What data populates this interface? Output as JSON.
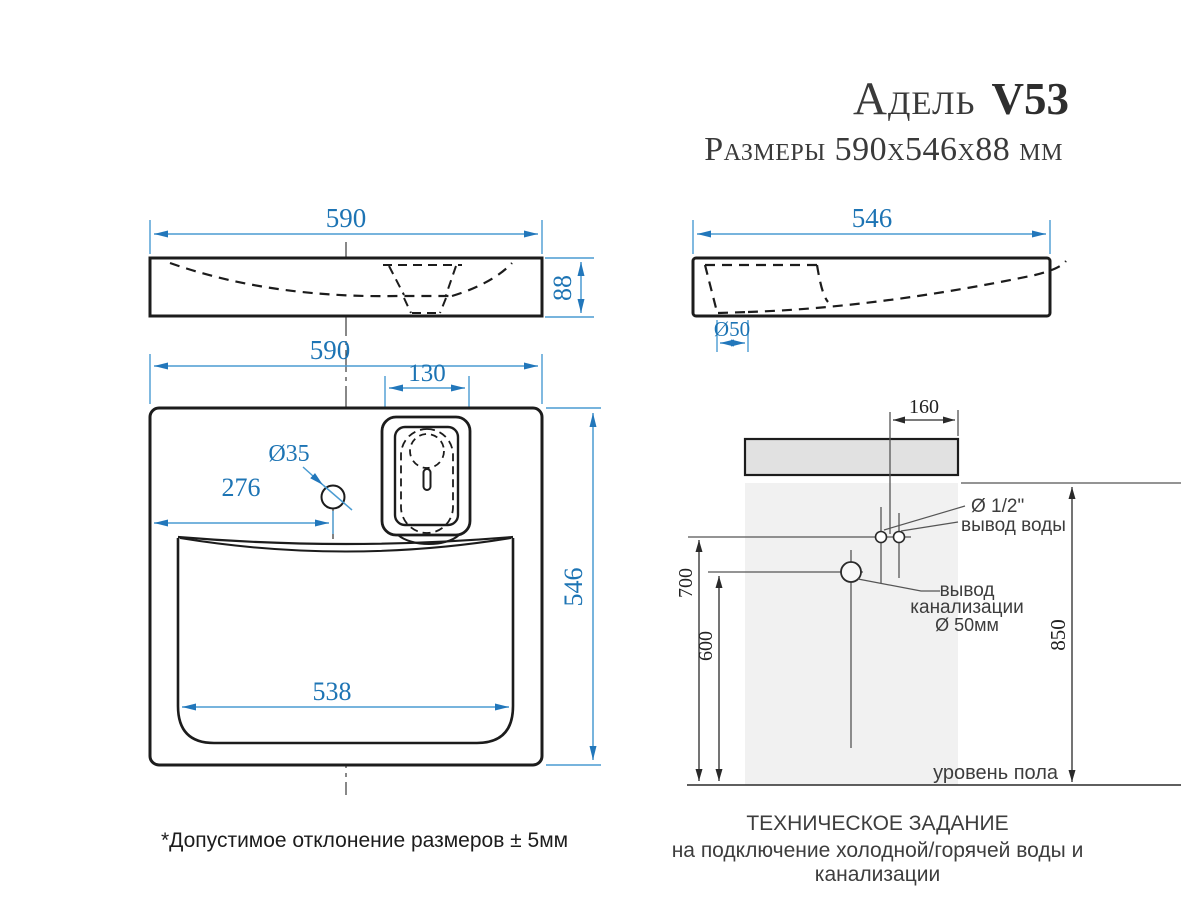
{
  "title": {
    "model": "Адель",
    "code": "V53",
    "dimensions": "Размеры 590х546х88 мм"
  },
  "front_view": {
    "width": "590",
    "height": "88"
  },
  "side_view": {
    "depth": "546",
    "drain_diameter": "Ø50"
  },
  "plan_view": {
    "width": "590",
    "recess_width": "130",
    "faucet_hole": "Ø35",
    "faucet_offset": "276",
    "depth": "546",
    "basin_width": "538"
  },
  "installation": {
    "tap_offset": "160",
    "water_height": "700",
    "drain_height": "600",
    "overall_height": "850",
    "water_label_line1": "Ø 1/2\"",
    "water_label_line2": "вывод воды",
    "drain_label_line1": "вывод",
    "drain_label_line2": "канализации",
    "drain_label_line3": "Ø 50мм",
    "floor_label": "уровень пола"
  },
  "footer": {
    "tolerance": "*Допустимое отклонение размеров ± 5мм",
    "spec_title": "ТЕХНИЧЕСКОЕ ЗАДАНИЕ",
    "spec_subtitle": "на подключение холодной/горячей воды и канализации"
  },
  "colors": {
    "dimension_blue": "#1d74b4",
    "dimension_line_blue": "#4a9bd2",
    "drawing_black": "#1c1c1c"
  }
}
